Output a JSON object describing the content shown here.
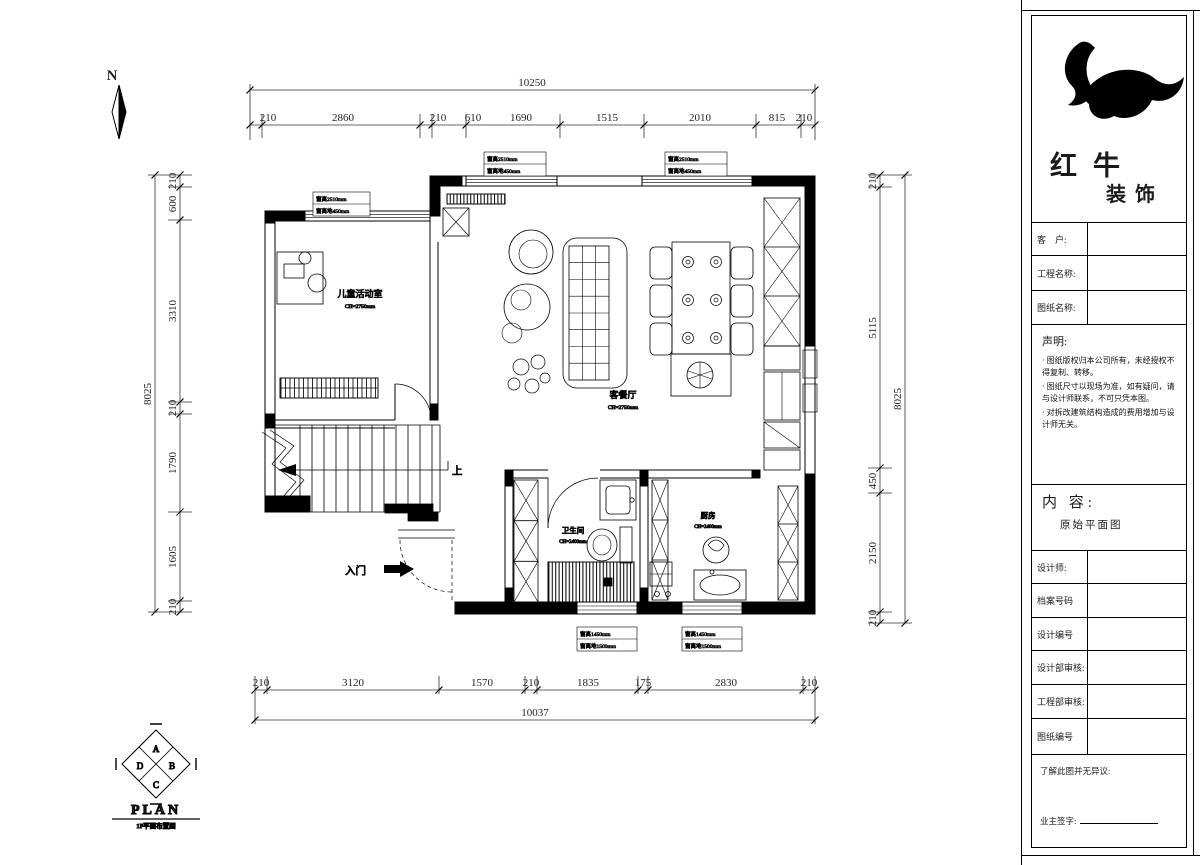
{
  "compass": {
    "label": "N"
  },
  "dimensions": {
    "top": {
      "total": "10250",
      "segments": [
        "210",
        "2860",
        "210",
        "610",
        "1690",
        "1515",
        "2010",
        "815",
        "210"
      ]
    },
    "bottom": {
      "total": "10037",
      "segments": [
        "210",
        "3120",
        "1570",
        "210",
        "1835",
        "175",
        "2830",
        "210"
      ]
    },
    "left": {
      "total": "8025",
      "segments": [
        "210",
        "600",
        "3310",
        "210",
        "1790",
        "1605",
        "210"
      ]
    },
    "right": {
      "total": "8025",
      "segments": [
        "210",
        "5115",
        "450",
        "2150",
        "210"
      ]
    }
  },
  "rooms": {
    "children": {
      "name": "儿童活动室",
      "note": "CH=2750mm"
    },
    "living": {
      "name": "客餐厅",
      "note": "CH=2750mm"
    },
    "bath": {
      "name": "卫生间",
      "note": "CH=2400mm"
    },
    "kitchen": {
      "name": "厨房",
      "note": "CH=2400mm"
    }
  },
  "annotations": {
    "entry": "入门",
    "up": "上",
    "window_labels": [
      {
        "l1": "窗高2510mm",
        "l2": "窗离地450mm"
      },
      {
        "l1": "窗高2510mm",
        "l2": "窗离地450mm"
      },
      {
        "l1": "窗高2510mm",
        "l2": "窗离地450mm"
      },
      {
        "l1": "窗高1450mm",
        "l2": "窗离地1500mm"
      },
      {
        "l1": "窗高1450mm",
        "l2": "窗离地1500mm"
      }
    ]
  },
  "plan_symbol": {
    "letters": [
      "A",
      "B",
      "C",
      "D"
    ],
    "title": "PLAN",
    "subtitle": "1F平面布置图"
  },
  "title_block": {
    "brand1": "红牛",
    "brand2": "装饰",
    "customer_label": "客　户:",
    "project_label": "工程名称:",
    "drawing_label": "图纸名称:",
    "statement_title": "声明:",
    "statement_items": [
      "· 图纸版权归本公司所有，未经授权不得复制、转移。",
      "· 图纸尺寸以现场为准，如有疑问，请与设计师联系，不可只凭本图。",
      "· 对拆改建筑结构造成的费用增加与设计师无关。"
    ],
    "content_label": "内 容:",
    "content_value": "原始平面图",
    "rows": [
      "设计师:",
      "档案号码",
      "设计编号",
      "设计部审核:",
      "工程部审核:",
      "图纸编号"
    ],
    "footer_note": "了解此图并无异议:",
    "footer_sign": "业主签字:"
  }
}
